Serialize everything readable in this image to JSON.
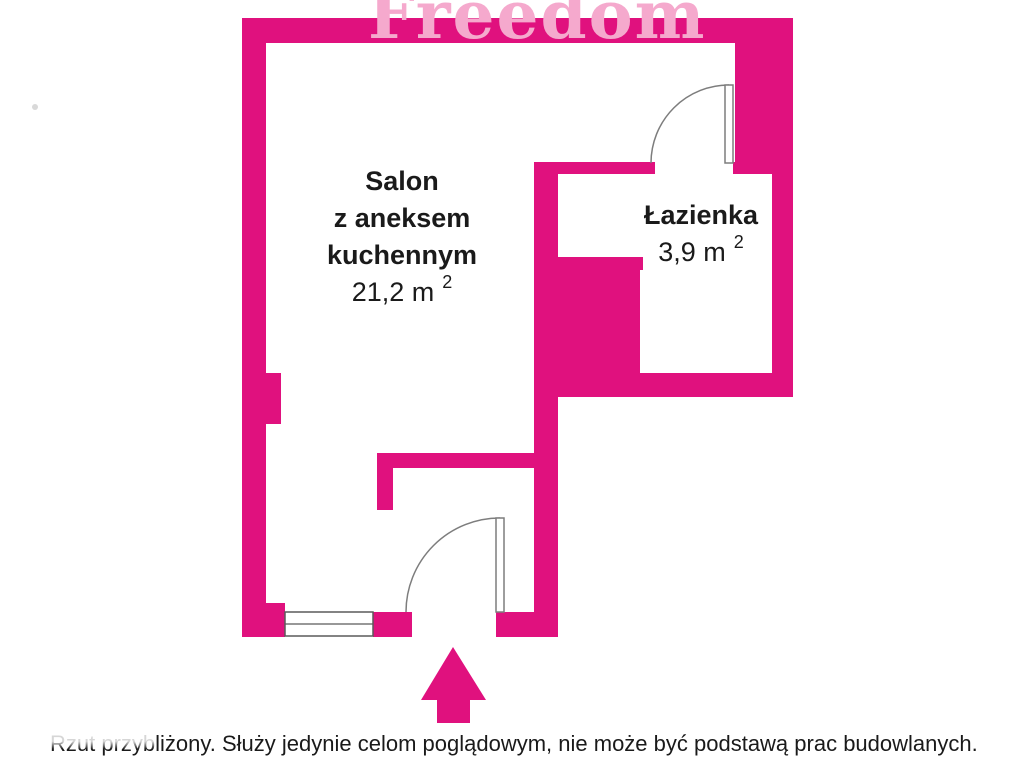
{
  "watermark": {
    "text": "Freedom"
  },
  "rooms": [
    {
      "id": "salon",
      "name_lines": [
        "Salon",
        "z aneksem",
        "kuchennym"
      ],
      "area": "21,2 m",
      "area_sup": "2"
    },
    {
      "id": "bathroom",
      "name_lines": [
        "Łazienka"
      ],
      "area": "3,9 m",
      "area_sup": "2"
    }
  ],
  "disclaimer": {
    "obscured_text": "Rzut przyb",
    "text": "liżony. Służy jedynie celom poglądowym, nie może być podstawą prac budowlanych."
  },
  "icons": {
    "entrance_arrow": "arrow-up",
    "doors": "quarter-circle-swing",
    "window": "triple-line-window"
  },
  "colors": {
    "wall": "#e0117e",
    "watermark": "#f5a9cd",
    "door_line": "#7d7d7d",
    "window_line": "#5a5a5a",
    "text": "#1a1a1a",
    "dot": "#b9b9b9"
  }
}
